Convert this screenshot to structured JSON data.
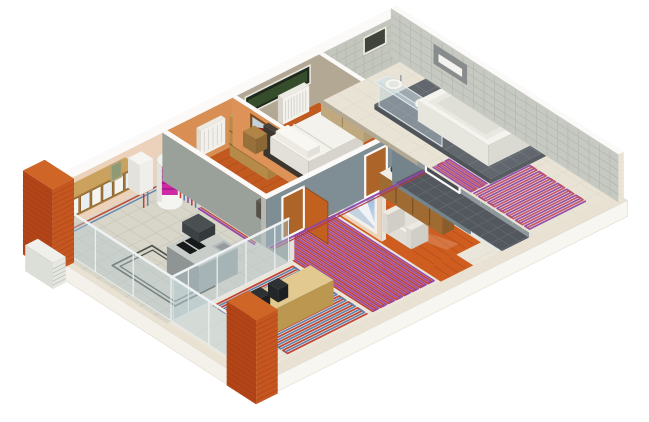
{
  "alt": "Isometric 3D cutaway of a one-storey apartment illustrating an underfloor heating system",
  "rooms": [
    "kitchen",
    "utility corner",
    "childrens room",
    "bedroom",
    "living-dining room",
    "hallway",
    "bathroom"
  ],
  "equipment": [
    "wall-hung boiler",
    "hot-water storage tank with magenta coil",
    "heating manifold",
    "underfloor heating coils",
    "panel radiator",
    "wall convector",
    "outdoor unit",
    "kitchen island with cooktop",
    "glass vanity with two sinks",
    "bathtub"
  ],
  "palette": {
    "bg": "#ffffff",
    "slabTop": "#e9e2d2",
    "slabSideL": "#f3f1ea",
    "slabSideR": "#f8f6f1",
    "kitchenTile": "#d8d5c9",
    "kitchenGrout": "#c7c4b9",
    "screed": "#ebe6da",
    "screedLine": "#dcd6c6",
    "woodFloor": "#c25a20",
    "woodJoint": "#a8491a",
    "woodIsland": "#cf5d1f",
    "darkTile": "#53585e",
    "darkTileLine": "#6a6f75",
    "platform": "#62676e",
    "platformLine": "#787d85",
    "bathFloor": "#e8e3d5",
    "wallTop": "#fbfaf8",
    "wallPink": "#ecd2ba",
    "wallOrange": "#d98f54",
    "wallTan": "#b3a894",
    "wallGreyBlue": "#7e8e94",
    "wallUtilGrey": "#9aa19b",
    "wallHallGrey": "#8e979b",
    "wallPinkLight": "#ecd3b8",
    "kidsEastOrange": "#dd9257",
    "tileWall": "#c3c6bd",
    "tileGrout": "#b2b5ad",
    "brick": "#cf6526",
    "brickSide": "#b24418",
    "brickFront": "#c65620",
    "brickLine": "#8f3a12",
    "glass": "rgba(182,202,210,0.42)",
    "glassEdge": "#e6ecee",
    "boiler": "#f5f5f2",
    "tankMagenta": "#cf2aa6",
    "manifoldRed": "#8c0f1f",
    "doorOrange": "#c2601f",
    "doorWood": "#ad6428",
    "furnWhite": "#f1f0ea",
    "bedHeadboard": "#4a4239",
    "counterWood": "#e2c98f",
    "stool": "#2e3134",
    "cabinetWood": "#caa25e",
    "sideboardWood": "#a06a33",
    "wardrobeTan": "#cbb795",
    "islandGrey": "#c9cdc9",
    "steel": "#b5bbbd",
    "cooktop": "#17191b",
    "hood": "#4a4f52",
    "skyTop": "#6f9fd2",
    "skyBottom": "#d7e2ee",
    "mountainWhite": "#f0f4f7",
    "windowDark": "#1f2a1c",
    "unitWhite": "#eff0ec"
  },
  "heating": {
    "zones": [
      {
        "name": "living-room-coil",
        "x1": 1.15,
        "y1": 3.15,
        "x2": 3.35,
        "y2": 4.92,
        "dir": "a",
        "step": 0.11,
        "colors": [
          "#c0392b",
          "#5b7fae"
        ]
      },
      {
        "name": "dining-area-coil",
        "x1": 3.5,
        "y1": 2.52,
        "x2": 5.22,
        "y2": 4.92,
        "dir": "b",
        "step": 0.11,
        "colors": [
          "#c0392b",
          "#9146a8"
        ]
      },
      {
        "name": "bathroom-coil",
        "x1": 7.95,
        "y1": 3.52,
        "x2": 9.5,
        "y2": 4.85,
        "dir": "a",
        "step": 0.11,
        "colors": [
          "#9146a8",
          "#c04f62"
        ]
      },
      {
        "name": "bathroom-coil-entry",
        "x1": 7.95,
        "y1": 2.55,
        "x2": 8.4,
        "y2": 3.45,
        "dir": "b",
        "step": 0.11,
        "colors": [
          "#9146a8",
          "#c04f62"
        ]
      }
    ],
    "kitchen_loop": {
      "x1": 0.55,
      "y1": 1.25,
      "x2": 1.65,
      "y2": 2.75,
      "color": "#3d423d"
    },
    "supply_lines": [
      {
        "name": "kitchen-wall-run",
        "color1": "#c0392b",
        "color2": "#5b7fae"
      },
      {
        "name": "corridor-run",
        "color1": "#9146a8",
        "color2": "#b03a4a"
      }
    ]
  }
}
